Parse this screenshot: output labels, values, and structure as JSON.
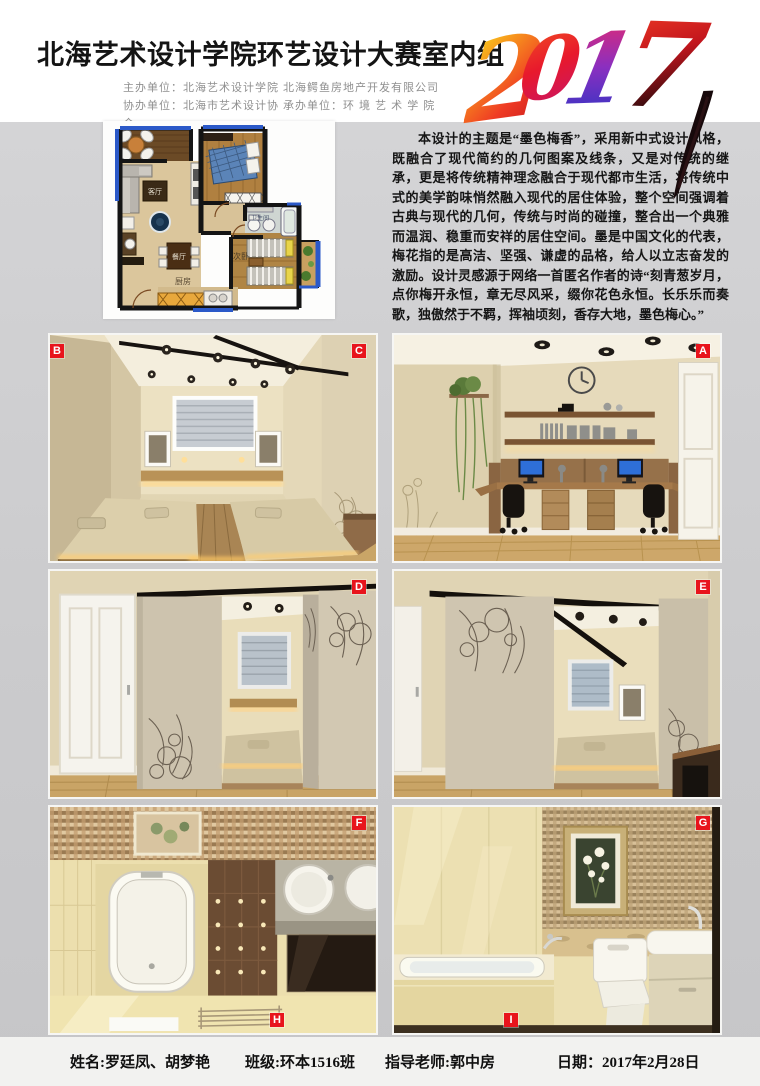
{
  "page": {
    "accent_red": "#e8141c",
    "bg_gray": "#cbcbcd"
  },
  "header": {
    "title": "北海艺术设计学院环艺设计大赛室内组",
    "organizer_rows": [
      {
        "c1": "主办单位：北海艺术设计学院",
        "c2": "北海鳄鱼房地产开发有限公司"
      },
      {
        "c1": "协办单位：北海市艺术设计协会",
        "c2": "承办单位：环 境 艺 术 学 院"
      }
    ],
    "year": {
      "d0": "2",
      "d1": "0",
      "d2": "1",
      "d3": "7"
    }
  },
  "intro": {
    "paragraph": "本设计的主题是“墨色梅香”，采用新中式设计风格，既融合了现代简约的几何图案及线条，又是对传统的继承，更是将传统精神理念融合于现代都市生活，将传统中式的美学韵味悄然融入现代的居住体验，整个空间强调着古典与现代的几何，传统与时尚的碰撞，整合出一个典雅而温润、稳重而安祥的居住空间。墨是中国文化的代表，梅花指的是高洁、坚强、谦虚的品格，给人以立志奋发的激励。设计灵感源于网络一首匿名作者的诗“刻青葱岁月，点你梅开永恒，章无尽风采，缀你花色永恒。长乐乐而奏歌，独傲然于不羁，挥袖顷刻，香存大地，墨色梅心。”"
  },
  "floorplan": {
    "rooms": {
      "living": "客厅",
      "dining": "餐厅",
      "kitchen": "厨房",
      "master": "主卧",
      "bath": "卫生间",
      "second": "次卧"
    }
  },
  "gallery": {
    "labels": {
      "a": "A",
      "b": "B",
      "c": "C",
      "d": "D",
      "e": "E",
      "f": "F",
      "g": "G",
      "h": "H",
      "i": "I"
    }
  },
  "footer": {
    "name": "姓名:罗廷凤、胡梦艳",
    "class": "班级:环本1516班",
    "teacher": "指导老师:郭中房",
    "date": "日期：2017年2月28日"
  }
}
